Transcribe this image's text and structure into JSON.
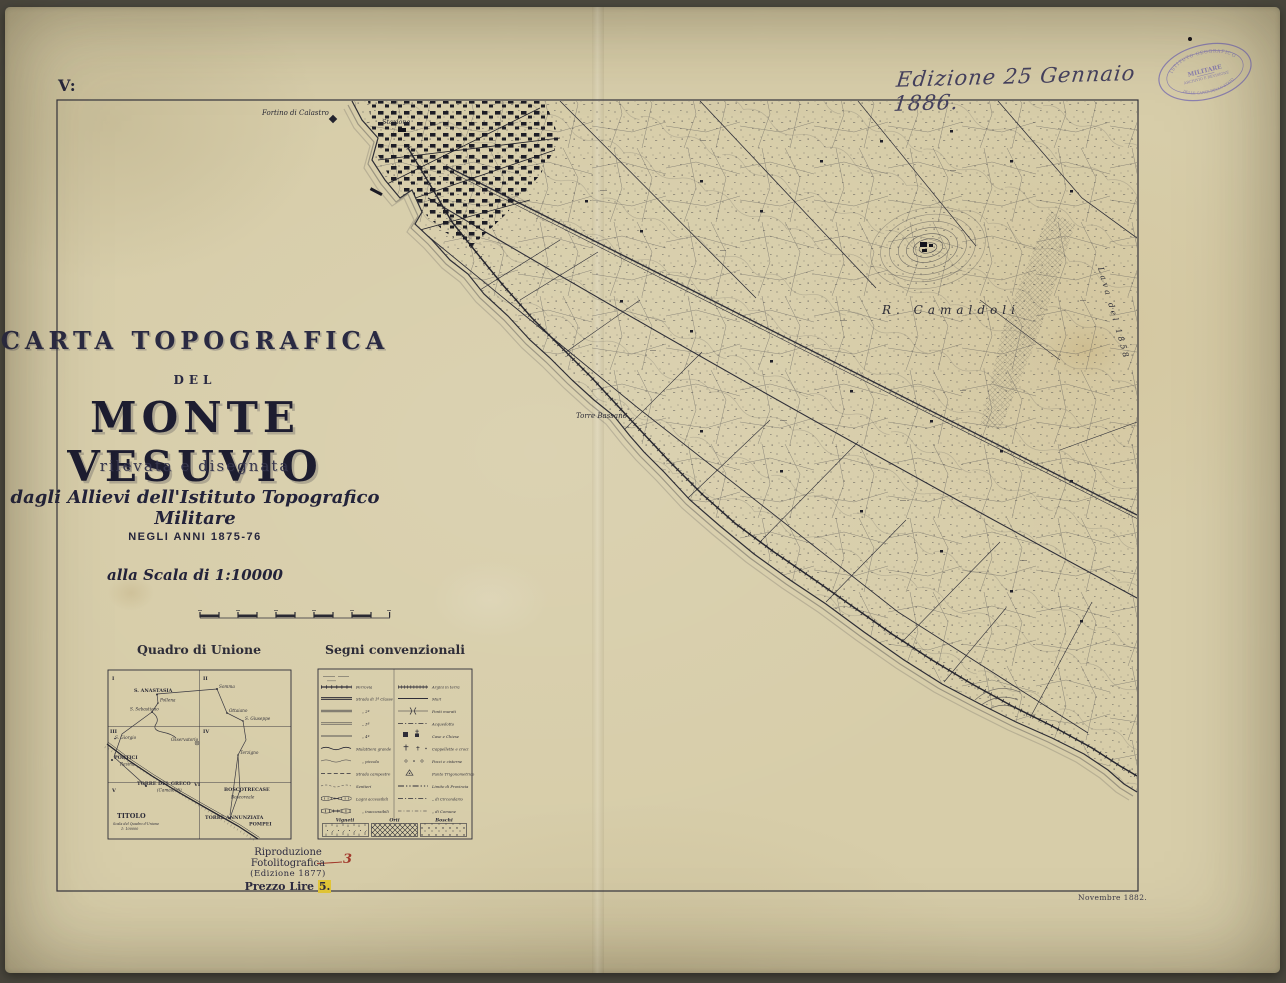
{
  "photo": {
    "backdrop_color": "#4f4d45",
    "paper_color": "#d7cda9",
    "ink_color": "#2e2d38",
    "stamp_color": "#7d72b2",
    "correction_red": "#a23a2c",
    "highlight_yellow": "#e2c637"
  },
  "sheet": {
    "sheet_number": "V:",
    "edition_note": "Edizione 25 Gennaio 1886.",
    "print_note": "Novembre 1882."
  },
  "stamp": {
    "arc_top": "ISTITUTO GEOGRAFICO",
    "center": "MILITARE",
    "mid": "ARCHIVIO E REVISIONE",
    "arc_bottom": "DELLE CARTE DELLO STATO"
  },
  "title_block": {
    "kind": "CARTA TOPOGRAFICA",
    "del": "DEL",
    "title": "MONTE VESUVIO",
    "sub1": "rilevata e disegnata",
    "sub2": "dagli Allievi dell'Istituto Topografico Militare",
    "years": "NEGLI ANNI 1875-76",
    "scale": "alla Scala di 1:10000"
  },
  "quadro": {
    "title": "Quadro di Unione",
    "quadrants": [
      "I",
      "II",
      "III",
      "IV",
      "V",
      "VI"
    ],
    "places": [
      "S. ANASTASIA",
      "Somma",
      "Pollena",
      "S. Sebastiano",
      "Ottaiano",
      "S. Giuseppe",
      "S. Giorgio",
      "Osservatorio",
      "Terzigno",
      "PORTICI",
      "Resina",
      "TORRE DEL GRECO",
      "(Camaldoli)",
      "BOSCOTRECASE",
      "Boscoreale",
      "TORRE ANNUNZIATA",
      "POMPEI"
    ],
    "titolo": {
      "label": "TITOLO",
      "sub": "Scala del Quadro d'Unione",
      "scale": "1: 100000"
    }
  },
  "legend": {
    "title": "Segni convenzionali",
    "left": [
      "Ferrovia",
      "Strada di 1ª Classe",
      "„    2ª",
      "„    3ª",
      "„    4ª",
      "Mulattiera grande",
      "„    piccola",
      "Strada campestre",
      "Sentieri",
      "Lagni accessibili",
      "„    inaccessibili"
    ],
    "right": [
      "Argini in terra",
      "Muri",
      "Ponti murati",
      "Acquedotto",
      "Case e Chiese",
      "Cappellette e croci",
      "Pozzi e cisterne",
      "Punto Trigonometrico",
      "Limite di Provincia",
      "„  di Circondario",
      "„  di Comune"
    ],
    "ground": [
      "Vigneti",
      "Orti",
      "Boschi"
    ]
  },
  "imprint": {
    "line1": "Riproduzione Fotolitografica",
    "line2": "(Edizione 1877)",
    "price_label": "Prezzo Lire",
    "price_old": "5.",
    "price_corrected": "3"
  },
  "map": {
    "labels": [
      "Fortino di Calastro",
      "Stazione",
      "Torre Bassano",
      "R. Camaldoli",
      "Lava del 1858"
    ]
  }
}
